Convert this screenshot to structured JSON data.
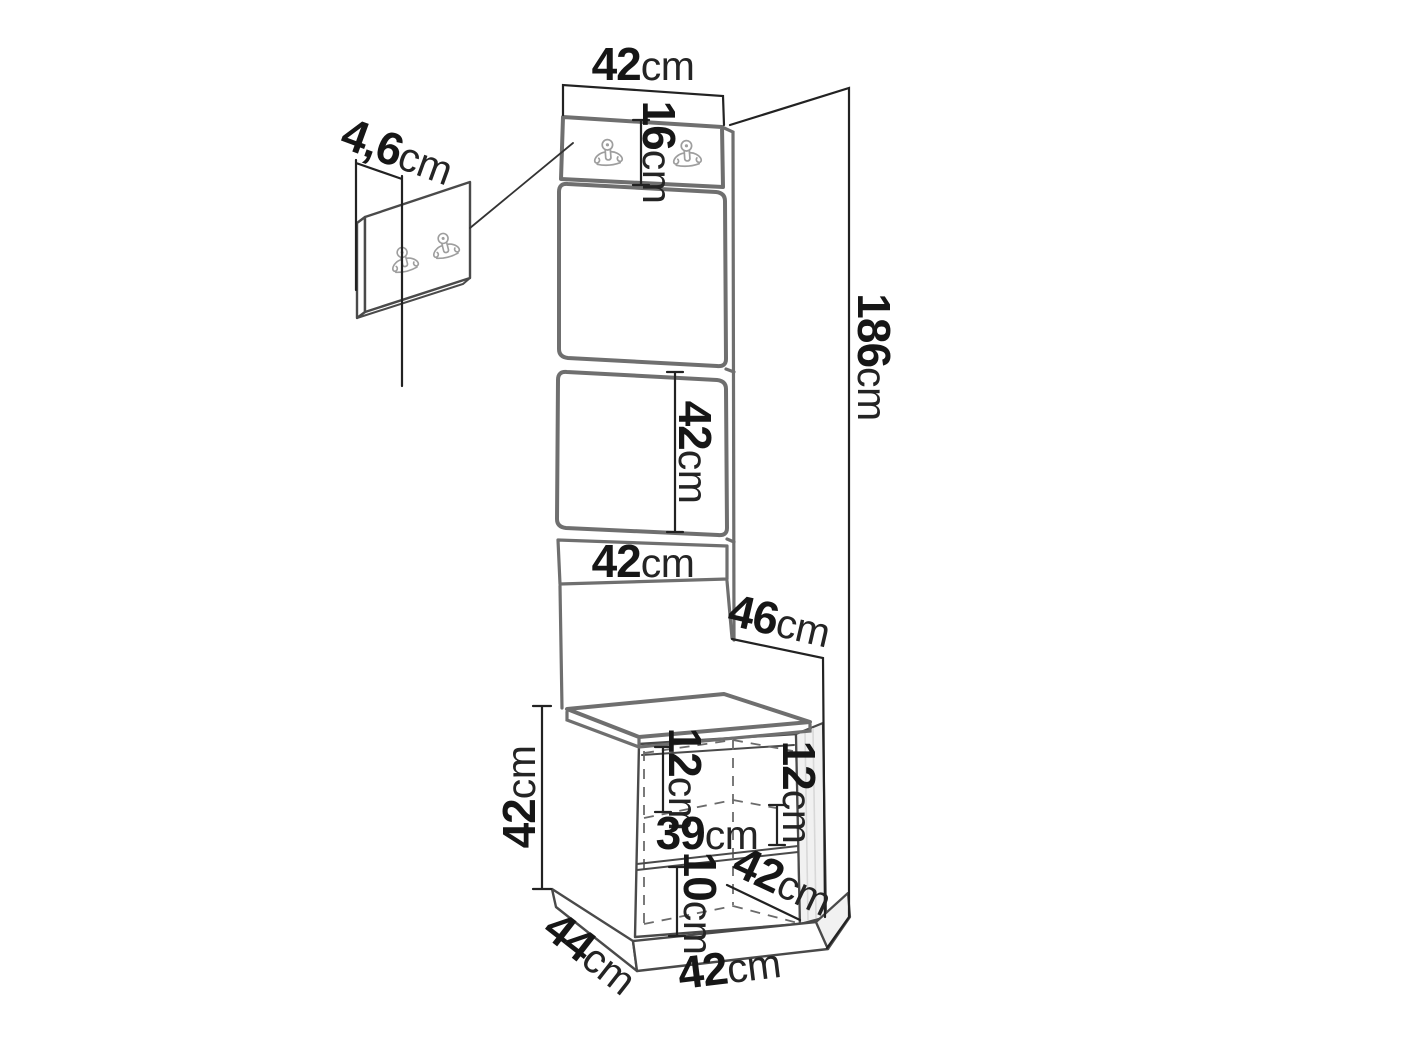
{
  "diagram": {
    "type": "furniture-dimension-diagram",
    "subject": "hallway-panel-with-coat-hooks-and-bench",
    "background": "#ffffff"
  },
  "colors": {
    "panel_outline": "#6f6f6f",
    "line": "#4a4a4a",
    "dimension_line": "#222222",
    "dashed_line": "#6b6b6b",
    "hook": "#9e9e9e",
    "text": "#161616",
    "shade": "#f1f1f1"
  },
  "icons": {
    "coat_hook": "double-prong-wall-hook-icon"
  },
  "labels": {
    "top_width": {
      "value": "42",
      "unit": "cm"
    },
    "hook_strip_height": {
      "value": "16",
      "unit": "cm"
    },
    "small_panel_thickness": {
      "value": "4,6",
      "unit": "cm"
    },
    "total_height": {
      "value": "186",
      "unit": "cm"
    },
    "mid_panel_height": {
      "value": "42",
      "unit": "cm"
    },
    "mid_panel_width": {
      "value": "42",
      "unit": "cm"
    },
    "total_depth": {
      "value": "46",
      "unit": "cm"
    },
    "bench_height": {
      "value": "42",
      "unit": "cm"
    },
    "top_opening_height": {
      "value": "12",
      "unit": "cm"
    },
    "middle_opening_height": {
      "value": "12",
      "unit": "cm"
    },
    "interior_width": {
      "value": "39",
      "unit": "cm"
    },
    "bottom_opening_height": {
      "value": "10",
      "unit": "cm"
    },
    "interior_depth": {
      "value": "42",
      "unit": "cm"
    },
    "bench_depth": {
      "value": "44",
      "unit": "cm"
    },
    "bench_width": {
      "value": "42",
      "unit": "cm"
    }
  }
}
